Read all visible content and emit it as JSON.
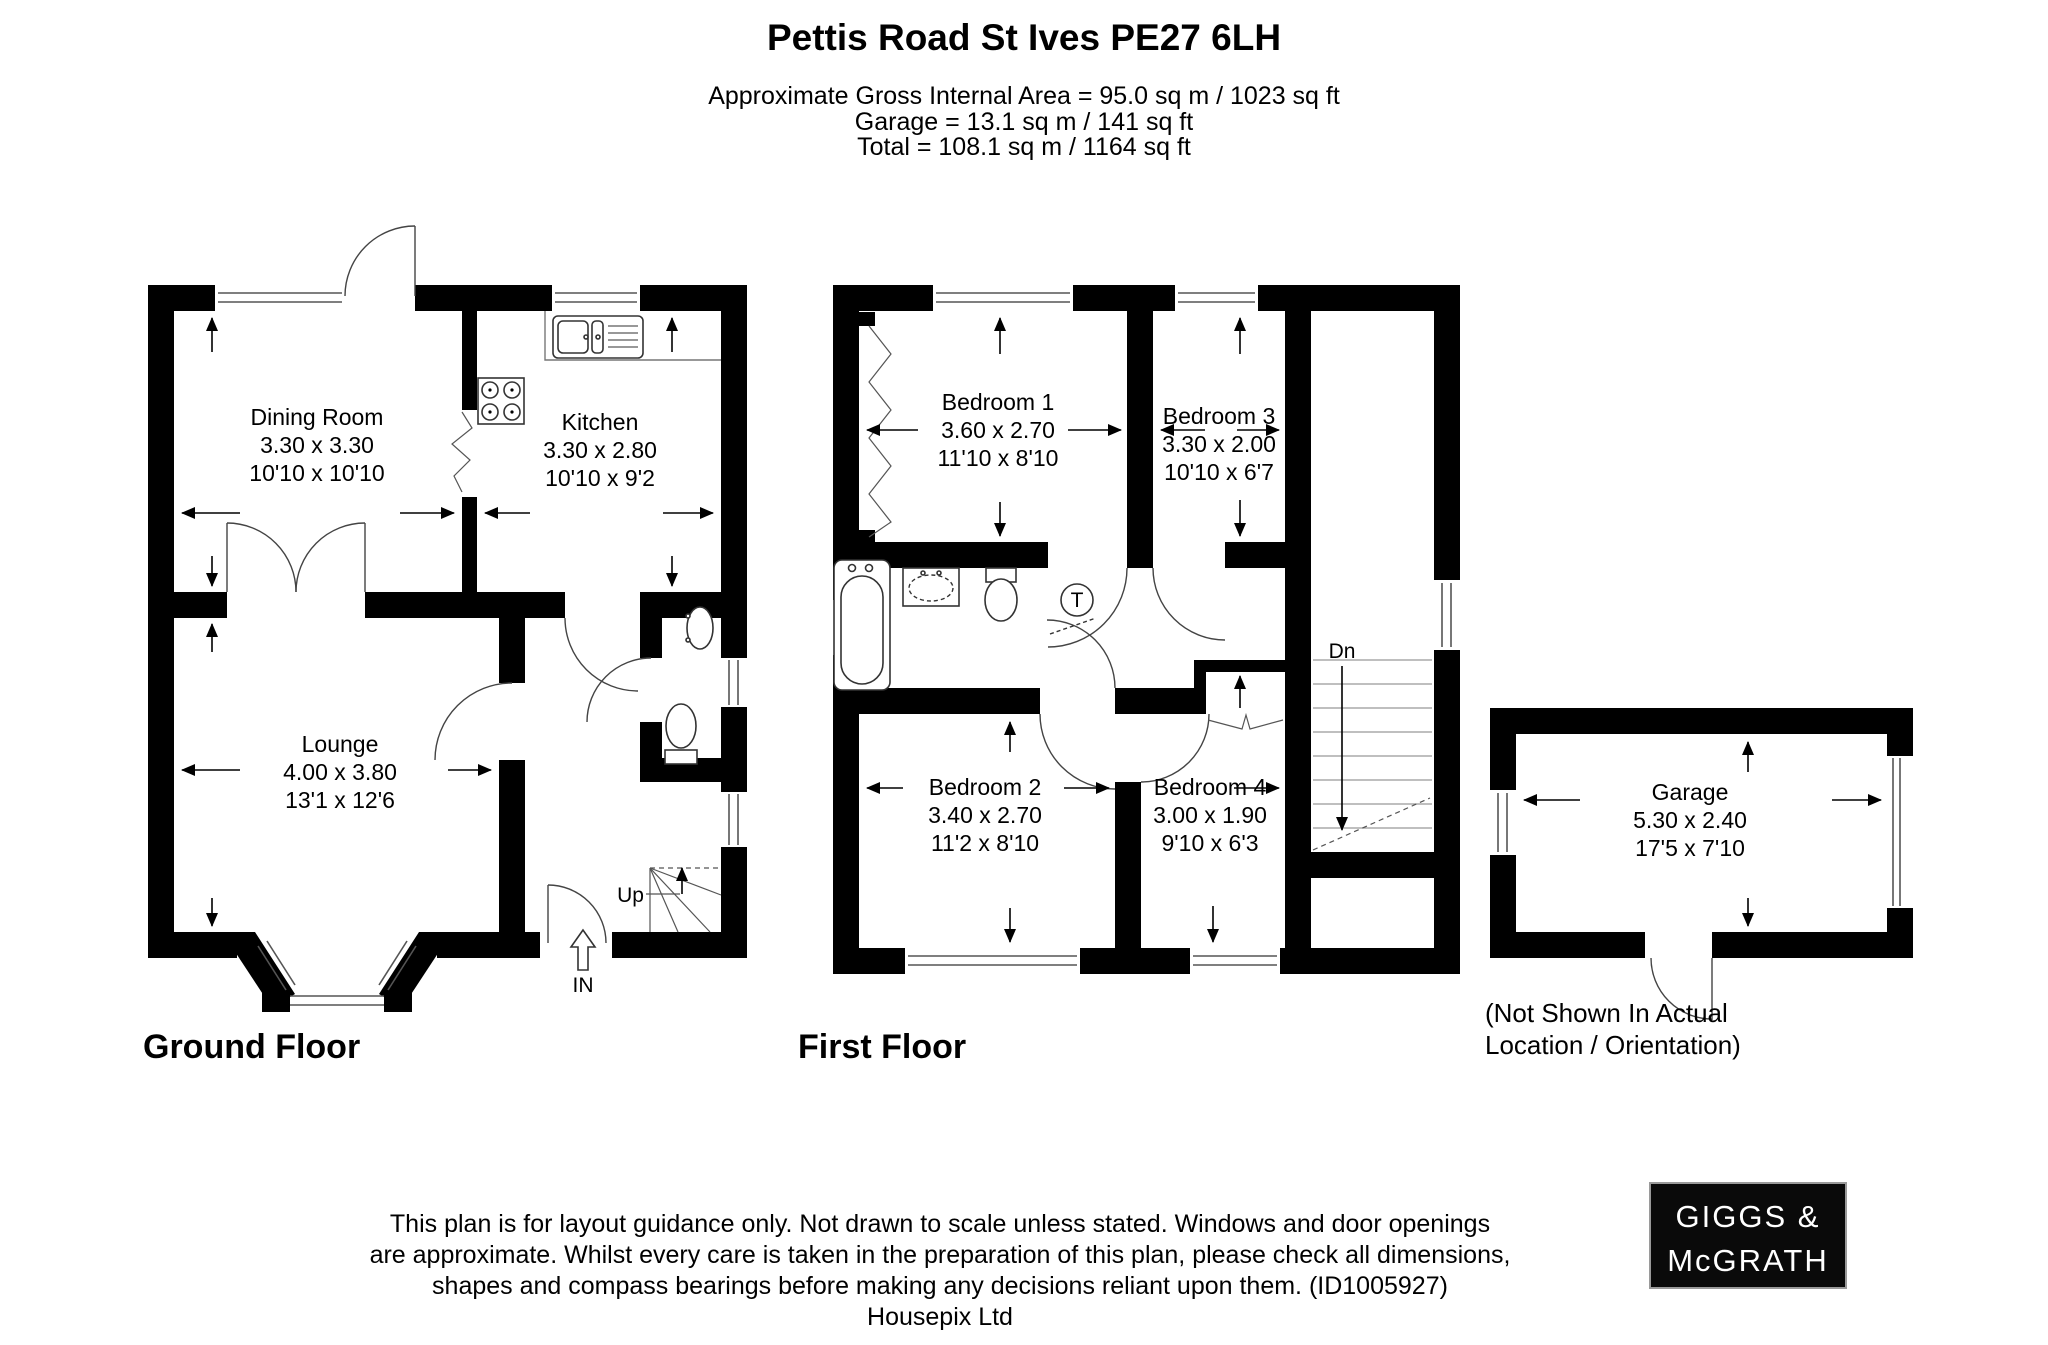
{
  "header": {
    "title": "Pettis Road St Ives PE27 6LH",
    "area_line": "Approximate Gross Internal Area = 95.0 sq m / 1023 sq ft",
    "garage_line": "Garage = 13.1 sq m / 141 sq ft",
    "total_line": "Total = 108.1 sq m / 1164 sq ft"
  },
  "ground_floor": {
    "label": "Ground Floor",
    "rooms": {
      "dining_room": {
        "name": "Dining Room",
        "metric": "3.30 x 3.30",
        "imperial": "10'10 x 10'10"
      },
      "kitchen": {
        "name": "Kitchen",
        "metric": "3.30 x 2.80",
        "imperial": "10'10 x 9'2"
      },
      "lounge": {
        "name": "Lounge",
        "metric": "4.00 x 3.80",
        "imperial": "13'1 x 12'6"
      }
    },
    "stairs_label": "Up",
    "entrance_label": "IN"
  },
  "first_floor": {
    "label": "First Floor",
    "rooms": {
      "bedroom1": {
        "name": "Bedroom 1",
        "metric": "3.60 x 2.70",
        "imperial": "11'10 x 8'10"
      },
      "bedroom2": {
        "name": "Bedroom 2",
        "metric": "3.40 x 2.70",
        "imperial": "11'2 x 8'10"
      },
      "bedroom3": {
        "name": "Bedroom 3",
        "metric": "3.30 x 2.00",
        "imperial": "10'10 x 6'7"
      },
      "bedroom4": {
        "name": "Bedroom 4",
        "metric": "3.00 x 1.90",
        "imperial": "9'10 x 6'3"
      }
    },
    "stairs_label": "Dn",
    "tank_label": "T"
  },
  "garage": {
    "room": {
      "name": "Garage",
      "metric": "5.30 x 2.40",
      "imperial": "17'5 x 7'10"
    },
    "note_line1": "(Not Shown In Actual",
    "note_line2": "Location / Orientation)"
  },
  "footer": {
    "line1": "This plan is for layout guidance only. Not drawn to scale unless stated. Windows and door openings",
    "line2": "are approximate. Whilst every care is taken in the preparation of this plan, please check all dimensions,",
    "line3": "shapes and compass bearings before making any decisions reliant upon them. (ID1005927)",
    "line4": "Housepix Ltd"
  },
  "logo": {
    "line1": "GIGGS &",
    "line2": "McGRATH"
  },
  "colors": {
    "wall": "#000000",
    "background": "#ffffff",
    "logo_bg": "#0a0a0a",
    "logo_text": "#ffffff"
  }
}
